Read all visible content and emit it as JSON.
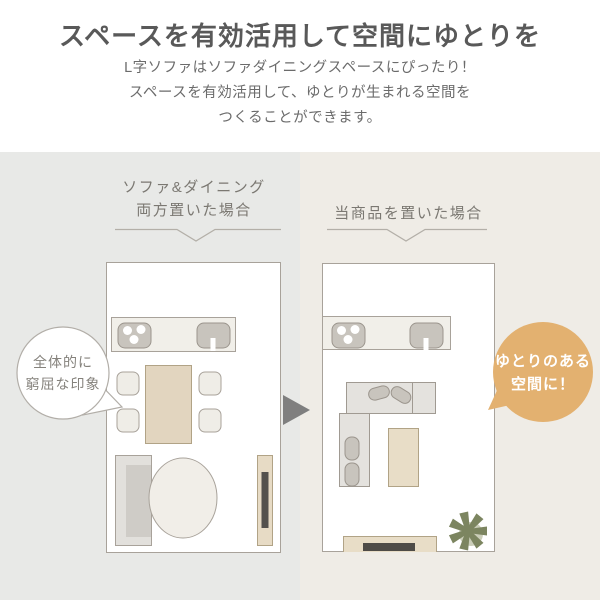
{
  "header": {
    "title": "スペースを有効活用して空間にゆとりを",
    "subtitle_lines": [
      "L字ソファはソファダイニングスペースにぴったり！",
      "スペースを有効活用して、ゆとりが生まれる空間を",
      "つくることができます。"
    ]
  },
  "comparison": {
    "before": {
      "caption_lines": [
        "ソファ&ダイニング",
        "両方置いた場合"
      ],
      "bubble_lines": [
        "全体的に",
        "窮屈な印象"
      ],
      "floorplan_items": [
        "kitchen-counter",
        "stove",
        "sink",
        "dining-table",
        "chair-x4",
        "sofa",
        "round-rug",
        "tv-stand"
      ]
    },
    "after": {
      "caption_lines": [
        "当商品を置いた場合"
      ],
      "bubble_lines": [
        "ゆとりのある",
        "空間に！"
      ],
      "floorplan_items": [
        "kitchen-counter",
        "stove",
        "sink",
        "l-shaped-sofa",
        "cushions",
        "coffee-table",
        "tv-stand",
        "plant"
      ]
    }
  },
  "icons": {
    "arrow": "right-triangle-arrow",
    "plant": "leaf-asterisk"
  },
  "colors": {
    "panel_before_bg": "#e8e9e7",
    "panel_after_bg": "#efece6",
    "title_text": "#595959",
    "subtitle_text": "#6b6b6b",
    "caption_text": "#7b7872",
    "room_border": "#a8a29a",
    "room_fill": "#ffffff",
    "counter_fill": "#f1efe9",
    "appliance_fill": "#c8c4bd",
    "wood_fill": "#e2d5bf",
    "wood_border": "#b1a386",
    "sofa_fill": "#e2e0dc",
    "sofa_seat": "#cfccc7",
    "tv_screen": "#54514d",
    "arrow_gray": "#7f7f7f",
    "accent_orange": "#e3b170",
    "plant_green": "#7c8560"
  }
}
